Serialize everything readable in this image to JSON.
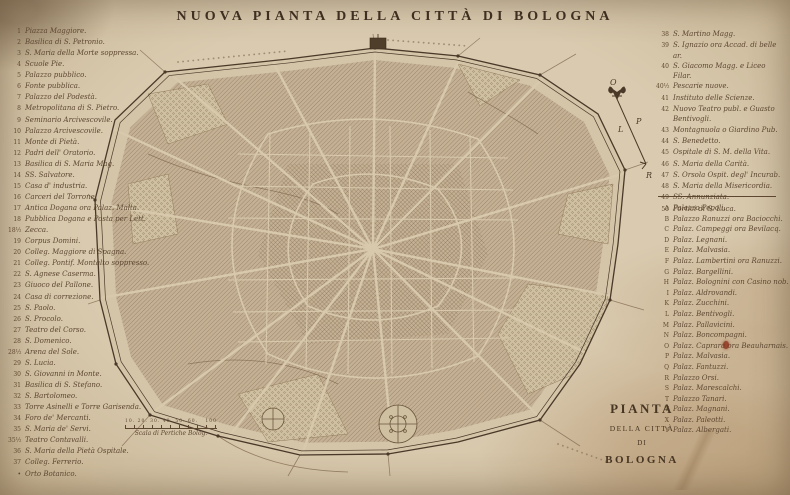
{
  "title": "NUOVA PIANTA DELLA CITTÀ DI BOLOGNA",
  "legend_left": {
    "items": [
      {
        "num": "1",
        "label": "Piazza Maggiore."
      },
      {
        "num": "2",
        "label": "Basilica di S. Petronio."
      },
      {
        "num": "3",
        "label": "S. Maria della Morte soppressa."
      },
      {
        "num": "4",
        "label": "Scuole Pie."
      },
      {
        "num": "5",
        "label": "Palazzo pubblico."
      },
      {
        "num": "6",
        "label": "Fonte pubblica."
      },
      {
        "num": "7",
        "label": "Palazzo del Podestà."
      },
      {
        "num": "8",
        "label": "Metropolitana di S. Pietro."
      },
      {
        "num": "9",
        "label": "Seminario Arcivescovile."
      },
      {
        "num": "10",
        "label": "Palazzo Arcivescovile."
      },
      {
        "num": "11",
        "label": "Monte di Pietà."
      },
      {
        "num": "12",
        "label": "Padri dell' Oratorio."
      },
      {
        "num": "13",
        "label": "Basilica di S. Maria Mag."
      },
      {
        "num": "14",
        "label": "SS. Salvatore."
      },
      {
        "num": "15",
        "label": "Casa d' industria."
      },
      {
        "num": "16",
        "label": "Carceri del Torrone."
      },
      {
        "num": "17",
        "label": "Antica Dogana ora Palaz. Malta."
      },
      {
        "num": "18",
        "label": "Pubblica Dogana e Posta per Lett."
      },
      {
        "num": "18½",
        "label": "Zecca."
      },
      {
        "num": "19",
        "label": "Corpus Domini."
      },
      {
        "num": "20",
        "label": "Colleg. Maggiore di Spagna."
      },
      {
        "num": "21",
        "label": "Colleg. Pontif. Montalto soppresso."
      },
      {
        "num": "22",
        "label": "S. Agnese Caserma."
      },
      {
        "num": "23",
        "label": "Giuoco del Pallone."
      },
      {
        "num": "24",
        "label": "Casa di correzione."
      },
      {
        "num": "25",
        "label": "S. Paolo."
      },
      {
        "num": "26",
        "label": "S. Procolo."
      },
      {
        "num": "27",
        "label": "Teatro del Corso."
      },
      {
        "num": "28",
        "label": "S. Domenico."
      },
      {
        "num": "28½",
        "label": "Arena del Sole."
      },
      {
        "num": "29",
        "label": "S. Lucia."
      },
      {
        "num": "30",
        "label": "S. Giovanni in Monte."
      },
      {
        "num": "31",
        "label": "Basilica di S. Stefano."
      },
      {
        "num": "32",
        "label": "S. Bartolomeo."
      },
      {
        "num": "33",
        "label": "Torre Asinelli e Torre Garisenda."
      },
      {
        "num": "34",
        "label": "Foro de' Mercanti."
      },
      {
        "num": "35",
        "label": "S. Maria de' Servi."
      },
      {
        "num": "35½",
        "label": "Teatro Contavalli."
      },
      {
        "num": "36",
        "label": "S. Maria della Pietà Ospitale."
      },
      {
        "num": "37",
        "label": "Colleg. Ferrerio."
      },
      {
        "num": "•",
        "label": "Orto Botanico."
      }
    ]
  },
  "legend_right": {
    "numbered": [
      {
        "num": "38",
        "label": "S. Martino Magg."
      },
      {
        "num": "39",
        "label": "S. Ignazio ora Accad. di belle ar."
      },
      {
        "num": "40",
        "label": "S. Giacomo Magg. e Liceo Filar."
      },
      {
        "num": "40½",
        "label": "Pescarie nuove."
      },
      {
        "num": "41",
        "label": "Instituto delle Scienze."
      },
      {
        "num": "42",
        "label": "Nuovo Teatro publ. e Guasto Bentivogli."
      },
      {
        "num": "43",
        "label": "Montagnuola o Giardino Pub."
      },
      {
        "num": "44",
        "label": "S. Benedetto."
      },
      {
        "num": "45",
        "label": "Ospitale di S. M. della Vita."
      },
      {
        "num": "46",
        "label": "S. Maria della Carità."
      },
      {
        "num": "47",
        "label": "S. Orsola Ospit. degl' Incurab."
      },
      {
        "num": "48",
        "label": "S. Maria della Misericordia."
      },
      {
        "num": "49",
        "label": "SS. Annunziata."
      },
      {
        "num": "50",
        "label": "Portici di S. Luca."
      }
    ],
    "lettered": [
      {
        "num": "A",
        "label": "Palazzo Pepoli."
      },
      {
        "num": "B",
        "label": "Palazzo Ranuzzi ora Baciocchi."
      },
      {
        "num": "C",
        "label": "Palaz. Campeggi ora Bevilacq."
      },
      {
        "num": "D",
        "label": "Palaz. Legnani."
      },
      {
        "num": "E",
        "label": "Palaz. Malvasia."
      },
      {
        "num": "F",
        "label": "Palaz. Lambertini ora Ranuzzi."
      },
      {
        "num": "G",
        "label": "Palaz. Bargellini."
      },
      {
        "num": "H",
        "label": "Palaz. Bolognini con Casino nob."
      },
      {
        "num": "I",
        "label": "Palaz. Aldrovandi."
      },
      {
        "num": "K",
        "label": "Palaz. Zucchini."
      },
      {
        "num": "L",
        "label": "Palaz. Bentivogli."
      },
      {
        "num": "M",
        "label": "Palaz. Pallavicini."
      },
      {
        "num": "N",
        "label": "Palaz. Boncompagni."
      },
      {
        "num": "O",
        "label": "Palaz. Caprara ora Beauharnais."
      },
      {
        "num": "P",
        "label": "Palaz. Malvasia."
      },
      {
        "num": "Q",
        "label": "Palaz. Fantuzzi."
      },
      {
        "num": "R",
        "label": "Palazzo Orsi."
      },
      {
        "num": "S",
        "label": "Palaz. Marescalchi."
      },
      {
        "num": "T",
        "label": "Palazzo Tanari."
      },
      {
        "num": "V",
        "label": "Palaz. Magnani."
      },
      {
        "num": "X",
        "label": "Palaz. Paleotti."
      },
      {
        "num": "Y",
        "label": "Palaz. Albergati."
      }
    ]
  },
  "cartouche": {
    "line1": "PIANTA",
    "line2": "DELLA CITTÀ",
    "line3": "DI",
    "line4": "BOLOGNA"
  },
  "compass": {
    "top": "O",
    "left": "L",
    "right": "P",
    "bottom": "R"
  },
  "scale_bar": {
    "ticks": "10. 20. 30. 40. 50. 60.",
    "end": "100",
    "label": "Scala di Pertiche Bolog."
  },
  "colors": {
    "paper": "#d9cab0",
    "ink": "#4a3828",
    "faded_ink": "#5d4731",
    "city_fill": "#c4b195",
    "stain_red": "#8a2d18"
  }
}
